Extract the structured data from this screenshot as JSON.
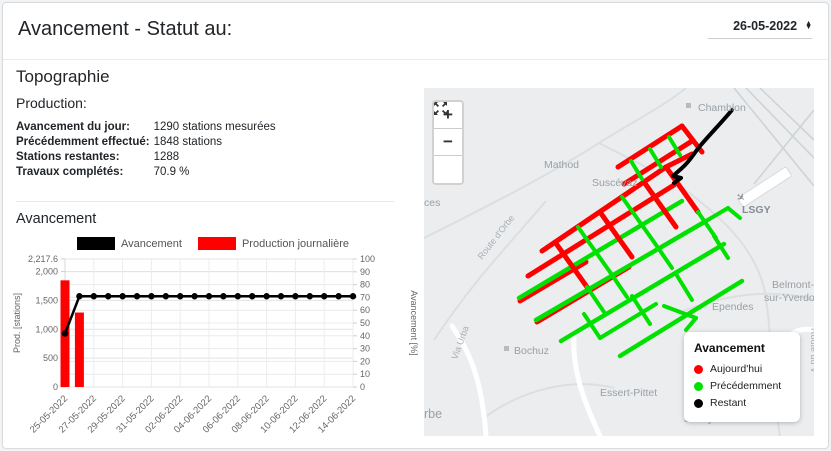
{
  "header": {
    "title": "Avancement - Statut au:",
    "date_select": {
      "value": "26-05-2022"
    }
  },
  "sections": {
    "topographie": "Topographie",
    "production": "Production:",
    "avancement": "Avancement"
  },
  "stats": [
    {
      "label": "Avancement du jour:",
      "value": "1290 stations mesurées"
    },
    {
      "label": "Précédemment effectué:",
      "value": "1848 stations"
    },
    {
      "label": "Stations restantes:",
      "value": "1288"
    },
    {
      "label": "Travaux complétés:",
      "value": "70.9 %"
    }
  ],
  "chart_data": {
    "type": "bar+line",
    "x": [
      "25-05-2022",
      "26-05-2022",
      "27-05-2022",
      "28-05-2022",
      "29-05-2022",
      "30-05-2022",
      "31-05-2022",
      "01-06-2022",
      "02-06-2022",
      "03-06-2022",
      "04-06-2022",
      "05-06-2022",
      "06-06-2022",
      "07-06-2022",
      "08-06-2022",
      "09-06-2022",
      "10-06-2022",
      "11-06-2022",
      "12-06-2022",
      "13-06-2022",
      "14-06-2022"
    ],
    "x_label_every": 2,
    "series": [
      {
        "name": "Avancement",
        "type": "line",
        "axis": "right",
        "color": "#000000",
        "values": [
          41.8,
          70.9,
          70.9,
          70.9,
          70.9,
          70.9,
          70.9,
          70.9,
          70.9,
          70.9,
          70.9,
          70.9,
          70.9,
          70.9,
          70.9,
          70.9,
          70.9,
          70.9,
          70.9,
          70.9,
          70.9
        ]
      },
      {
        "name": "Production journalière",
        "type": "bar",
        "axis": "left",
        "color": "#ff0000",
        "values": [
          1848,
          1290,
          0,
          0,
          0,
          0,
          0,
          0,
          0,
          0,
          0,
          0,
          0,
          0,
          0,
          0,
          0,
          0,
          0,
          0,
          0
        ]
      }
    ],
    "left_axis": {
      "label": "Prod. [stations]",
      "max": 2217.6,
      "ticks": [
        {
          "v": 0,
          "t": "0"
        },
        {
          "v": 500,
          "t": "500"
        },
        {
          "v": 1000,
          "t": "1,000"
        },
        {
          "v": 1500,
          "t": "1,500"
        },
        {
          "v": 2000,
          "t": "2,000"
        },
        {
          "v": 2217.6,
          "t": "2,217.6"
        }
      ]
    },
    "right_axis": {
      "label": "Avancement [%]",
      "max": 100,
      "ticks": [
        {
          "v": 0,
          "t": "0"
        },
        {
          "v": 10,
          "t": "10"
        },
        {
          "v": 20,
          "t": "20"
        },
        {
          "v": 30,
          "t": "30"
        },
        {
          "v": 40,
          "t": "40"
        },
        {
          "v": 50,
          "t": "50"
        },
        {
          "v": 60,
          "t": "60"
        },
        {
          "v": 70,
          "t": "70"
        },
        {
          "v": 80,
          "t": "80"
        },
        {
          "v": 90,
          "t": "90"
        },
        {
          "v": 100,
          "t": "100"
        }
      ]
    },
    "grid": true,
    "legend_position": "top"
  },
  "map": {
    "controls": {
      "zoom_in": "+",
      "zoom_out": "−"
    },
    "labels": {
      "chamblon": "Chamblon",
      "mathod": "Mathod",
      "suscevaz": "Suscévaz",
      "lsgy": "LSGY",
      "route_orbe": "Route d'Orbe",
      "belmont_1": "Belmont-",
      "belmont_2": "sur-Yverdon",
      "ependes": "Ependes",
      "bochuz": "Bochuz",
      "via_urba": "Via Urba",
      "essert_pittet": "Essert-Pittet",
      "suchy": "Suchy",
      "orbe_partial": "rbe",
      "ces_partial": "ces",
      "route_du_v": "Route du V"
    },
    "legend": {
      "title": "Avancement",
      "items": [
        {
          "label": "Aujourd'hui",
          "color": "#ff0000"
        },
        {
          "label": "Précédemment",
          "color": "#00e100"
        },
        {
          "label": "Restant",
          "color": "#000000"
        }
      ]
    }
  }
}
